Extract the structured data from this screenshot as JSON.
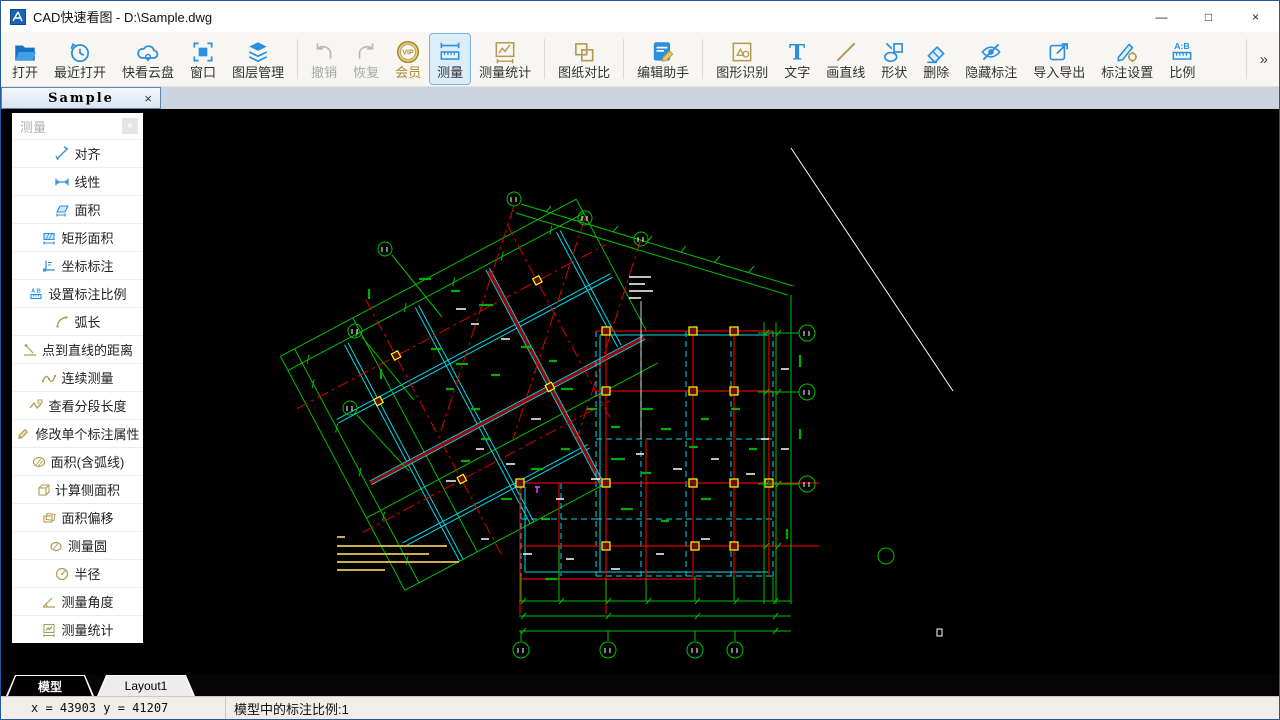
{
  "window": {
    "title": "CAD快速看图 - D:\\Sample.dwg",
    "controls": {
      "minimize": "—",
      "maximize": "□",
      "close": "×"
    }
  },
  "icons": {
    "vip_glyph": "VIP",
    "text_tool_glyph": "T",
    "scale_glyph": "A:B"
  },
  "toolbar": {
    "overflow_glyph": "»",
    "buttons": [
      {
        "label": "打开",
        "icon": "open-folder-icon",
        "state": "normal"
      },
      {
        "label": "最近打开",
        "icon": "recent-clock-icon",
        "state": "normal"
      },
      {
        "label": "快看云盘",
        "icon": "cloud-drive-icon",
        "state": "normal"
      },
      {
        "label": "窗口",
        "icon": "window-select-icon",
        "state": "normal"
      },
      {
        "label": "图层管理",
        "icon": "layers-icon",
        "state": "normal"
      },
      {
        "label": "撤销",
        "icon": "undo-icon",
        "state": "disabled"
      },
      {
        "label": "恢复",
        "icon": "redo-icon",
        "state": "disabled"
      },
      {
        "label": "会员",
        "icon": "vip-badge-icon",
        "state": "normal"
      },
      {
        "label": "测量",
        "icon": "measure-ruler-icon",
        "state": "active"
      },
      {
        "label": "测量统计",
        "icon": "measure-stats-icon",
        "state": "normal"
      },
      {
        "label": "图纸对比",
        "icon": "drawing-compare-icon",
        "state": "normal"
      },
      {
        "label": "编辑助手",
        "icon": "edit-assistant-icon",
        "state": "normal"
      },
      {
        "label": "图形识别",
        "icon": "shape-recognition-icon",
        "state": "normal"
      },
      {
        "label": "文字",
        "icon": "text-tool-icon",
        "state": "normal"
      },
      {
        "label": "画直线",
        "icon": "draw-line-icon",
        "state": "normal"
      },
      {
        "label": "形状",
        "icon": "shapes-icon",
        "state": "normal"
      },
      {
        "label": "删除",
        "icon": "eraser-icon",
        "state": "normal"
      },
      {
        "label": "隐藏标注",
        "icon": "hide-annotation-icon",
        "state": "normal"
      },
      {
        "label": "导入导出",
        "icon": "import-export-icon",
        "state": "normal"
      },
      {
        "label": "标注设置",
        "icon": "annotation-settings-icon",
        "state": "normal"
      },
      {
        "label": "比例",
        "icon": "scale-ratio-icon",
        "state": "normal"
      }
    ]
  },
  "doc_tabs": [
    {
      "label": "Sample",
      "close_glyph": "×",
      "active": true
    }
  ],
  "panel": {
    "title": "测量",
    "close_glyph": "×",
    "items": [
      {
        "label": "对齐",
        "icon": "align-measure-icon"
      },
      {
        "label": "线性",
        "icon": "linear-measure-icon"
      },
      {
        "label": "面积",
        "icon": "area-icon"
      },
      {
        "label": "矩形面积",
        "icon": "rect-area-icon"
      },
      {
        "label": "坐标标注",
        "icon": "coordinate-icon"
      },
      {
        "label": "设置标注比例",
        "icon": "scale-ratio-icon"
      },
      {
        "label": "弧长",
        "icon": "arc-length-icon"
      },
      {
        "label": "点到直线的距离",
        "icon": "point-line-distance-icon"
      },
      {
        "label": "连续测量",
        "icon": "continuous-measure-icon"
      },
      {
        "label": "查看分段长度",
        "icon": "segment-length-icon"
      },
      {
        "label": "修改单个标注属性",
        "icon": "edit-label-icon"
      },
      {
        "label": "面积(含弧线)",
        "icon": "area-arc-icon"
      },
      {
        "label": "计算侧面积",
        "icon": "side-area-icon"
      },
      {
        "label": "面积偏移",
        "icon": "area-offset-icon"
      },
      {
        "label": "测量圆",
        "icon": "measure-circle-icon"
      },
      {
        "label": "半径",
        "icon": "radius-icon"
      },
      {
        "label": "测量角度",
        "icon": "angle-icon"
      },
      {
        "label": "测量统计",
        "icon": "measure-stats-icon"
      }
    ]
  },
  "canvas": {
    "description": "black model space showing a rotated structural floor-plan drawing",
    "colors": {
      "background": "#000000",
      "dimension_green": "#00c000",
      "beam_cyan": "#00d8e8",
      "axis_red": "#dd0000",
      "column_yellow": "#ffff00",
      "note_yellow": "#c8b050",
      "annotation_white": "#ffffff"
    }
  },
  "sheet_tabs": [
    {
      "label": "模型",
      "active": true
    },
    {
      "label": "Layout1",
      "active": false
    }
  ],
  "status_bar": {
    "coordinates": "x = 43903 y = 41207",
    "scale_info": "模型中的标注比例:1"
  }
}
